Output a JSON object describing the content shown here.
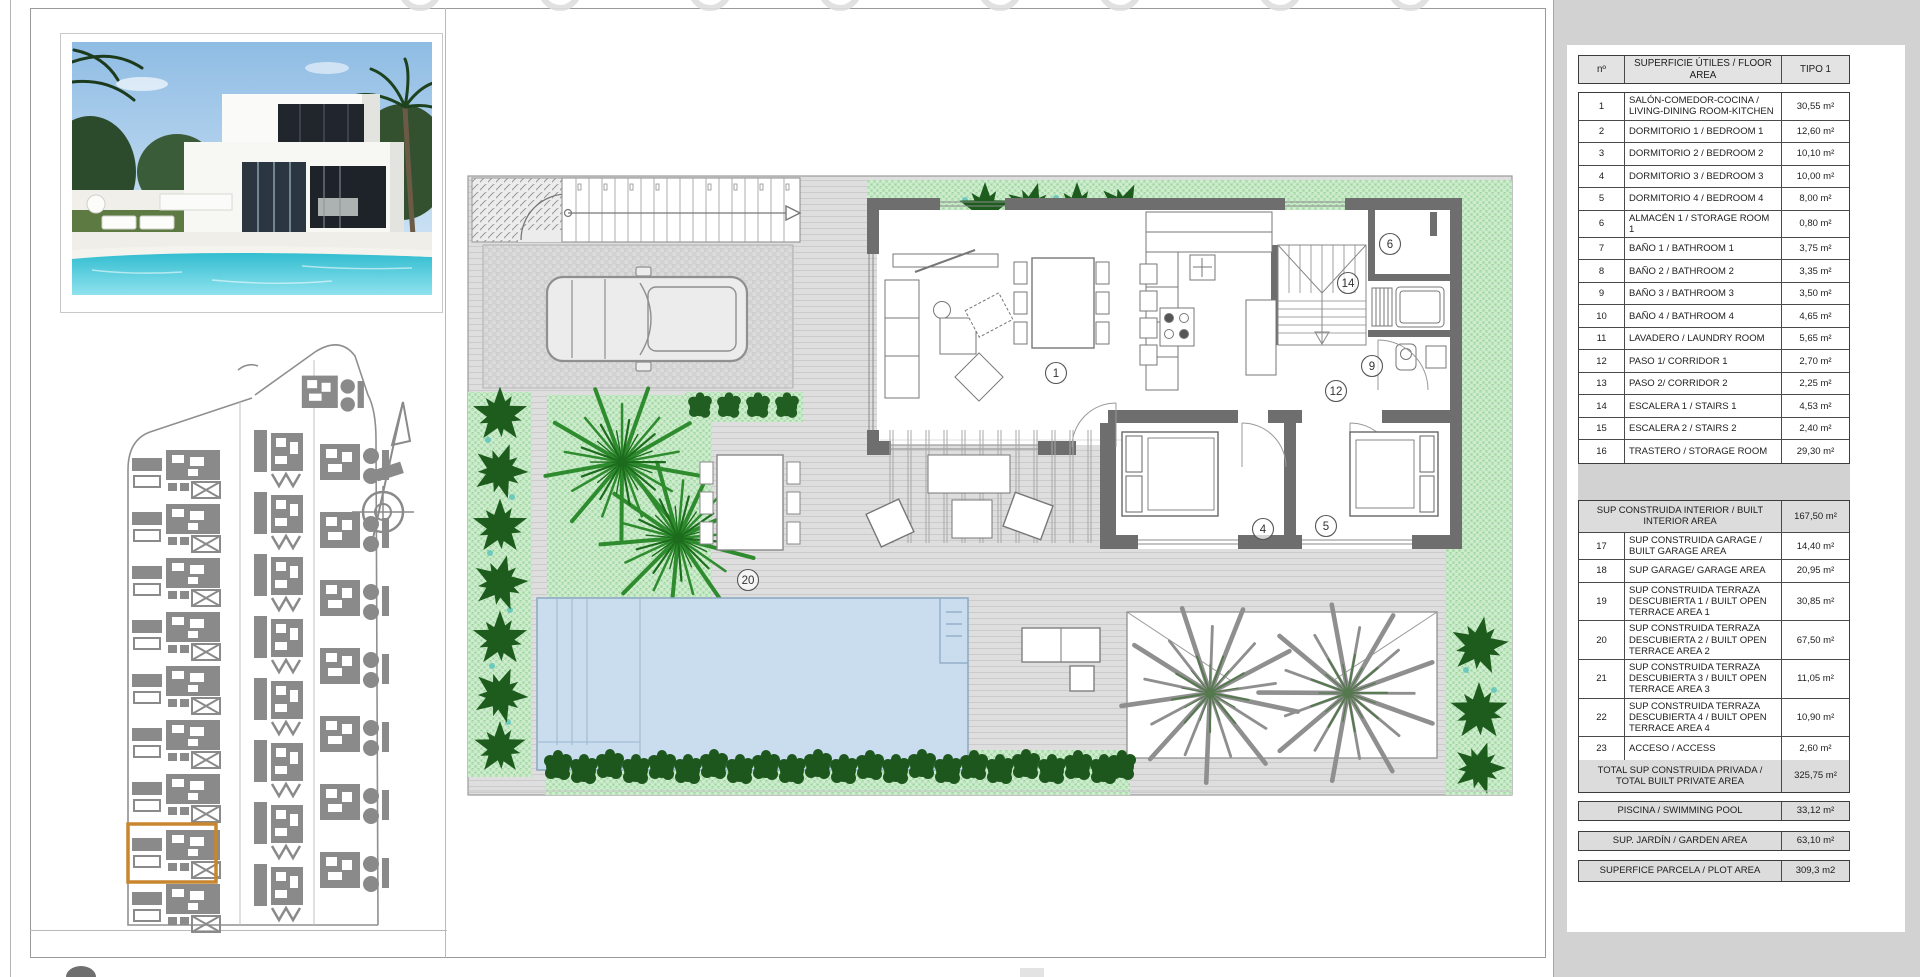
{
  "colors": {
    "sidebar": "#d2d2d2",
    "garden_green": "#b7e1b7",
    "tree_green": "#1e5c1e",
    "pool_blue": "#c9ddef",
    "wall_gray": "#6e6e6e",
    "highlight_orange": "#c8862f"
  },
  "table": {
    "header": {
      "num": "nº",
      "desc": "SUPERFICIE ÚTILES / FLOOR AREA",
      "type": "TIPO 1"
    },
    "rows": [
      {
        "n": "1",
        "desc": "SALÓN-COMEDOR-COCINA / LIVING-DINING ROOM-KITCHEN",
        "val": "30,55 m²"
      },
      {
        "n": "2",
        "desc": "DORMITORIO 1 / BEDROOM 1",
        "val": "12,60 m²"
      },
      {
        "n": "3",
        "desc": "DORMITORIO 2 / BEDROOM 2",
        "val": "10,10 m²"
      },
      {
        "n": "4",
        "desc": "DORMITORIO 3 / BEDROOM 3",
        "val": "10,00 m²"
      },
      {
        "n": "5",
        "desc": "DORMITORIO 4 / BEDROOM 4",
        "val": "8,00 m²"
      },
      {
        "n": "6",
        "desc": "ALMACÉN 1 / STORAGE ROOM 1",
        "val": "0,80 m²"
      },
      {
        "n": "7",
        "desc": "BAÑO 1 / BATHROOM 1",
        "val": "3,75 m²"
      },
      {
        "n": "8",
        "desc": "BAÑO 2 / BATHROOM 2",
        "val": "3,35 m²"
      },
      {
        "n": "9",
        "desc": "BAÑO 3 / BATHROOM 3",
        "val": "3,50 m²"
      },
      {
        "n": "10",
        "desc": "BAÑO 4 / BATHROOM 4",
        "val": "4,65 m²"
      },
      {
        "n": "11",
        "desc": "LAVADERO / LAUNDRY ROOM",
        "val": "5,65 m²"
      },
      {
        "n": "12",
        "desc": "PASO 1/ CORRIDOR 1",
        "val": "2,70 m²"
      },
      {
        "n": "13",
        "desc": "PASO 2/ CORRIDOR 2",
        "val": "2,25 m²"
      },
      {
        "n": "14",
        "desc": "ESCALERA 1 / STAIRS 1",
        "val": "4,53 m²"
      },
      {
        "n": "15",
        "desc": "ESCALERA 2 / STAIRS 2",
        "val": "2,40 m²"
      },
      {
        "n": "16",
        "desc": "TRASTERO / STORAGE ROOM",
        "val": "29,30 m²"
      }
    ],
    "interior_total": {
      "desc": "SUP CONSTRUIDA INTERIOR / BUILT INTERIOR AREA",
      "val": "167,50 m²"
    },
    "rows2": [
      {
        "n": "17",
        "desc": "SUP CONSTRUIDA GARAGE / BUILT GARAGE AREA",
        "val": "14,40 m²"
      },
      {
        "n": "18",
        "desc": "SUP GARAGE/ GARAGE AREA",
        "val": "20,95 m²"
      },
      {
        "n": "19",
        "desc": "SUP CONSTRUIDA TERRAZA DESCUBIERTA 1 / BUILT OPEN TERRACE AREA 1",
        "val": "30,85 m²"
      },
      {
        "n": "20",
        "desc": "SUP CONSTRUIDA TERRAZA DESCUBIERTA 2 / BUILT OPEN TERRACE AREA 2",
        "val": "67,50 m²"
      },
      {
        "n": "21",
        "desc": "SUP CONSTRUIDA TERRAZA DESCUBIERTA 3 / BUILT OPEN TERRACE AREA 3",
        "val": "11,05 m²"
      },
      {
        "n": "22",
        "desc": "SUP CONSTRUIDA TERRAZA DESCUBIERTA 4 / BUILT OPEN TERRACE AREA 4",
        "val": "10,90 m²"
      },
      {
        "n": "23",
        "desc": "ACCESO / ACCESS",
        "val": "2,60 m²"
      }
    ],
    "total_private": {
      "desc": "TOTAL SUP CONSTRUIDA PRIVADA / TOTAL BUILT PRIVATE AREA",
      "val": "325,75 m²"
    },
    "summary": [
      {
        "desc": "PISCINA / SWIMMING POOL",
        "val": "33,12 m²"
      },
      {
        "desc": "SUP. JARDÍN / GARDEN AREA",
        "val": "63,10 m²"
      },
      {
        "desc": "SUPERFICE PARCELA / PLOT AREA",
        "val": "309,3 m2"
      }
    ]
  },
  "plan": {
    "labels": [
      {
        "text": "1"
      },
      {
        "text": "4"
      },
      {
        "text": "5"
      },
      {
        "text": "6"
      },
      {
        "text": "9"
      },
      {
        "text": "12"
      },
      {
        "text": "14"
      },
      {
        "text": "20"
      }
    ]
  }
}
